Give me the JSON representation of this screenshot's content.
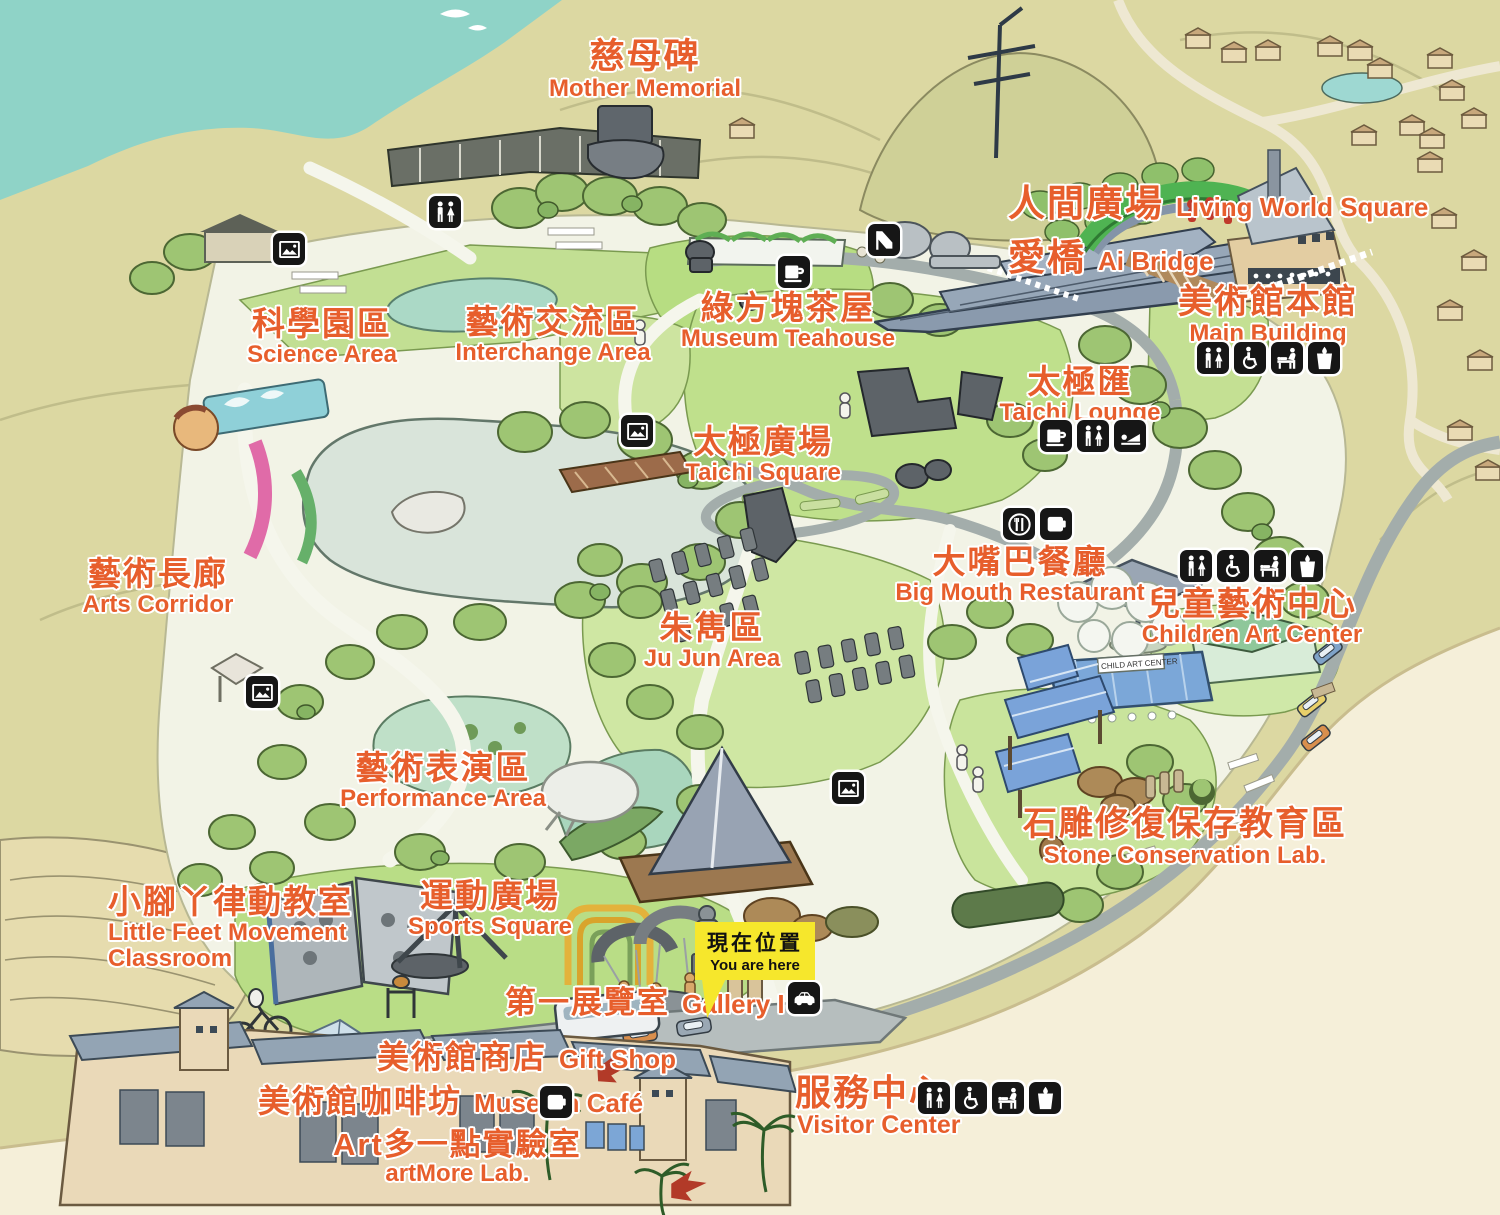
{
  "labels": {
    "mother_memorial": {
      "zh": "慈母碑",
      "en": "Mother Memorial"
    },
    "living_world_square": {
      "zh": "人間廣場",
      "en": "Living World Square"
    },
    "ai_bridge": {
      "zh": "愛橋",
      "en": "Ai Bridge"
    },
    "main_building": {
      "zh": "美術館本館",
      "en": "Main Building"
    },
    "museum_teahouse": {
      "zh": "綠方塊茶屋",
      "en": "Museum Teahouse"
    },
    "science_area": {
      "zh": "科學園區",
      "en": "Science Area"
    },
    "interchange_area": {
      "zh": "藝術交流區",
      "en": "Interchange Area"
    },
    "taichi_lounge": {
      "zh": "太極匯",
      "en": "Taichi Lounge"
    },
    "taichi_square": {
      "zh": "太極廣場",
      "en": "Taichi Square"
    },
    "big_mouth_restaurant": {
      "zh": "大嘴巴餐廳",
      "en": "Big Mouth Restaurant"
    },
    "children_art_center": {
      "zh": "兒童藝術中心",
      "en": "Children Art Center"
    },
    "arts_corridor": {
      "zh": "藝術長廊",
      "en": "Arts Corridor"
    },
    "ju_jun_area": {
      "zh": "朱雋區",
      "en": "Ju Jun Area"
    },
    "performance_area": {
      "zh": "藝術表演區",
      "en": "Performance Area"
    },
    "stone_conservation_lab": {
      "zh": "石雕修復保存教育區",
      "en": "Stone Conservation Lab."
    },
    "little_feet": {
      "zh": "小腳丫律動教室",
      "en_line1": "Little Feet Movement",
      "en_line2": "Classroom"
    },
    "sports_square": {
      "zh": "運動廣場",
      "en": "Sports Square"
    },
    "gallery_one": {
      "zh": "第一展覽室",
      "en": "Gallery I"
    },
    "gift_shop": {
      "zh": "美術館商店",
      "en": "Gift Shop"
    },
    "museum_cafe": {
      "zh": "美術館咖啡坊",
      "en": "Museum Café"
    },
    "artmore_lab": {
      "zh": "Art多一點實驗室",
      "en": "artMore Lab."
    },
    "visitor_center": {
      "zh": "服務中心",
      "en": "Visitor Center"
    },
    "you_are_here": {
      "zh": "現在位置",
      "en": "You are here"
    }
  },
  "signs": {
    "child_art_center_building": "CHILD ART CENTER"
  },
  "facility_icons": {
    "science_restroom": [
      "restroom-icon"
    ],
    "science_photo": [
      "photo-spot-icon"
    ],
    "slide_spot": [
      "slide-icon"
    ],
    "museum_teahouse": [
      "cafe-icon"
    ],
    "main_building": [
      "restroom-icon",
      "wheelchair-icon",
      "nursing-room-icon",
      "drinking-water-icon"
    ],
    "taichi_lounge": [
      "cafe-icon",
      "restroom-icon",
      "lounge-icon"
    ],
    "taichi_photo": [
      "photo-spot-icon"
    ],
    "gazebo_photo": [
      "photo-spot-icon"
    ],
    "performance_photo": [
      "photo-spot-icon"
    ],
    "big_mouth_restaurant": [
      "restaurant-icon",
      "beverage-icon"
    ],
    "children_art_center": [
      "restroom-icon",
      "wheelchair-icon",
      "nursing-room-icon",
      "drinking-water-icon"
    ],
    "parking": [
      "parking-icon"
    ],
    "museum_cafe": [
      "beverage-icon"
    ],
    "visitor_center": [
      "restroom-icon",
      "wheelchair-icon",
      "nursing-room-icon",
      "drinking-water-icon"
    ]
  },
  "colors": {
    "label_orange": "#e75e2c",
    "marker_yellow": "#f6e72c",
    "icon_black": "#161616",
    "sea_teal": "#8fd3c7",
    "hill_olive": "#dcd8a2",
    "sand_cream": "#f5efd9"
  }
}
